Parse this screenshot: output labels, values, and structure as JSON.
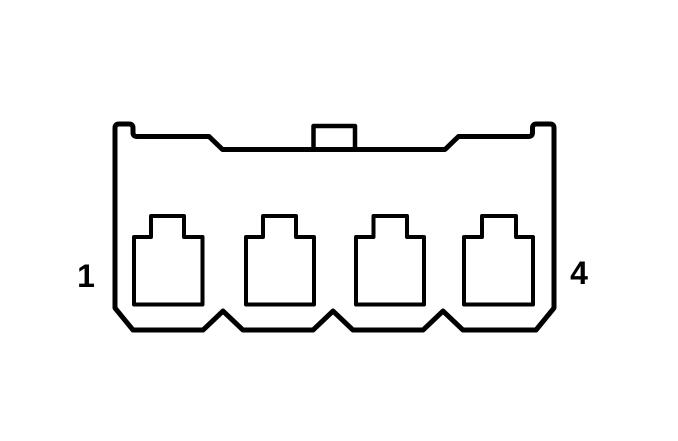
{
  "connector": {
    "pin_label_left": "1",
    "pin_label_right": "4",
    "cavity_count": 4,
    "line_color": "#000000",
    "background_color": "#ffffff"
  }
}
